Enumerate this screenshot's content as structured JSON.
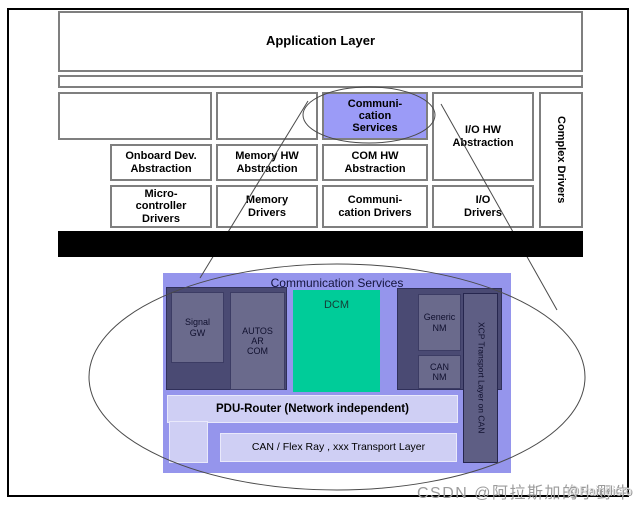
{
  "upper": {
    "application_layer": "Application Layer",
    "comm_services": "Communi-\ncation\nServices",
    "io_hw_abstraction": "I/O HW\nAbstraction",
    "complex_drivers": "Complex Drivers",
    "onboard_dev_abstraction": "Onboard Dev.\nAbstraction",
    "memory_hw_abstraction": "Memory HW\nAbstraction",
    "com_hw_abstraction": "COM HW\nAbstraction",
    "microcontroller_drivers": "Micro-\ncontroller\nDrivers",
    "memory_drivers": "Memory\nDrivers",
    "communication_drivers": "Communi-\ncation Drivers",
    "io_drivers": "I/O\nDrivers",
    "microcontroller_bar": "Microcontroller (µC)"
  },
  "lower": {
    "title": "Communication Services",
    "signal_gw": "Signal\nGW",
    "autosar_com": "AUTOS\nAR\nCOM",
    "dcm": "DCM",
    "generic_nm": "Generic\nNM",
    "can_nm": "CAN\nNM",
    "xcp": "XCP Transport Layer on CAN",
    "pdu_router": "PDU-Router (Network independent)",
    "transport_layer": "CAN / Flex Ray , xxx  Transport Layer"
  },
  "watermark": {
    "primary": "CSDN @阿拉斯加的小野牛",
    "overlay": "@Raindicro"
  },
  "colors": {
    "highlight_purple": "#9b9bf7",
    "panel_purple": "#9595ec",
    "dark_panel": "#4a4a73",
    "inner_gray_box": "#6a6a8c",
    "dcm_green": "#00cc99",
    "light_bar": "#cfcff4",
    "mcu_bar": "#000000"
  }
}
